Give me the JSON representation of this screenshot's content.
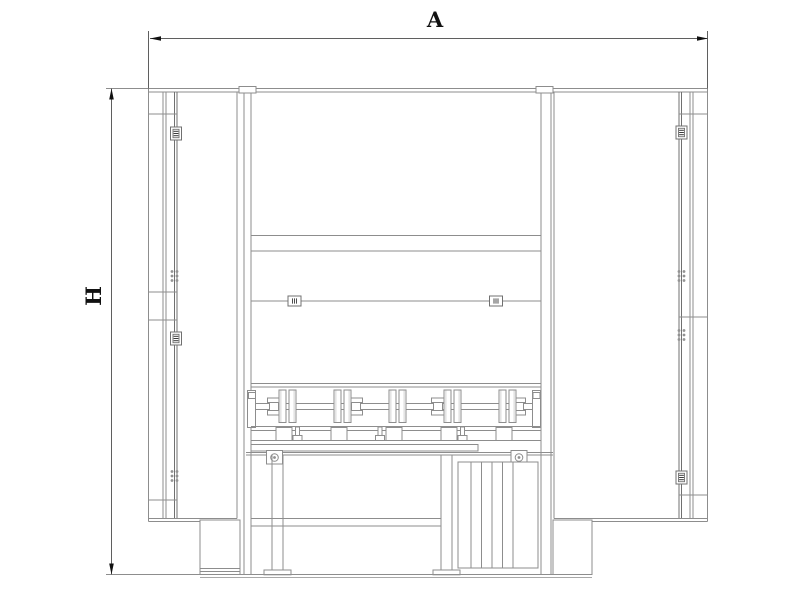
{
  "drawing": {
    "type": "technical-drawing-front-elevation",
    "dimension_annotations": {
      "width_label": "A",
      "height_label": "H"
    },
    "colors": {
      "background": "#ffffff",
      "machine_line": "#8d8d8d",
      "strong_line": "#707070",
      "dimension_line": "#5f5f5f",
      "arrow_and_label": "#111111",
      "hinge_detail": "#3a3a3a",
      "faint_mark": "#b0b0b0"
    },
    "components": {
      "left_cabinet": {
        "solid_hinges": 2,
        "hidden_hinge_marks": 2,
        "panel_ticks": 4
      },
      "right_cabinet": {
        "solid_hinges": 2,
        "hidden_hinge_marks": 2,
        "panel_ticks": 3
      },
      "center_body": {
        "roller_disc_pairs": 5,
        "shaft_collars": 4,
        "rail_blocks": 5,
        "rail_clips": 3,
        "seam_clips": 2,
        "legs": 2,
        "bolt_circles": 2
      }
    }
  }
}
